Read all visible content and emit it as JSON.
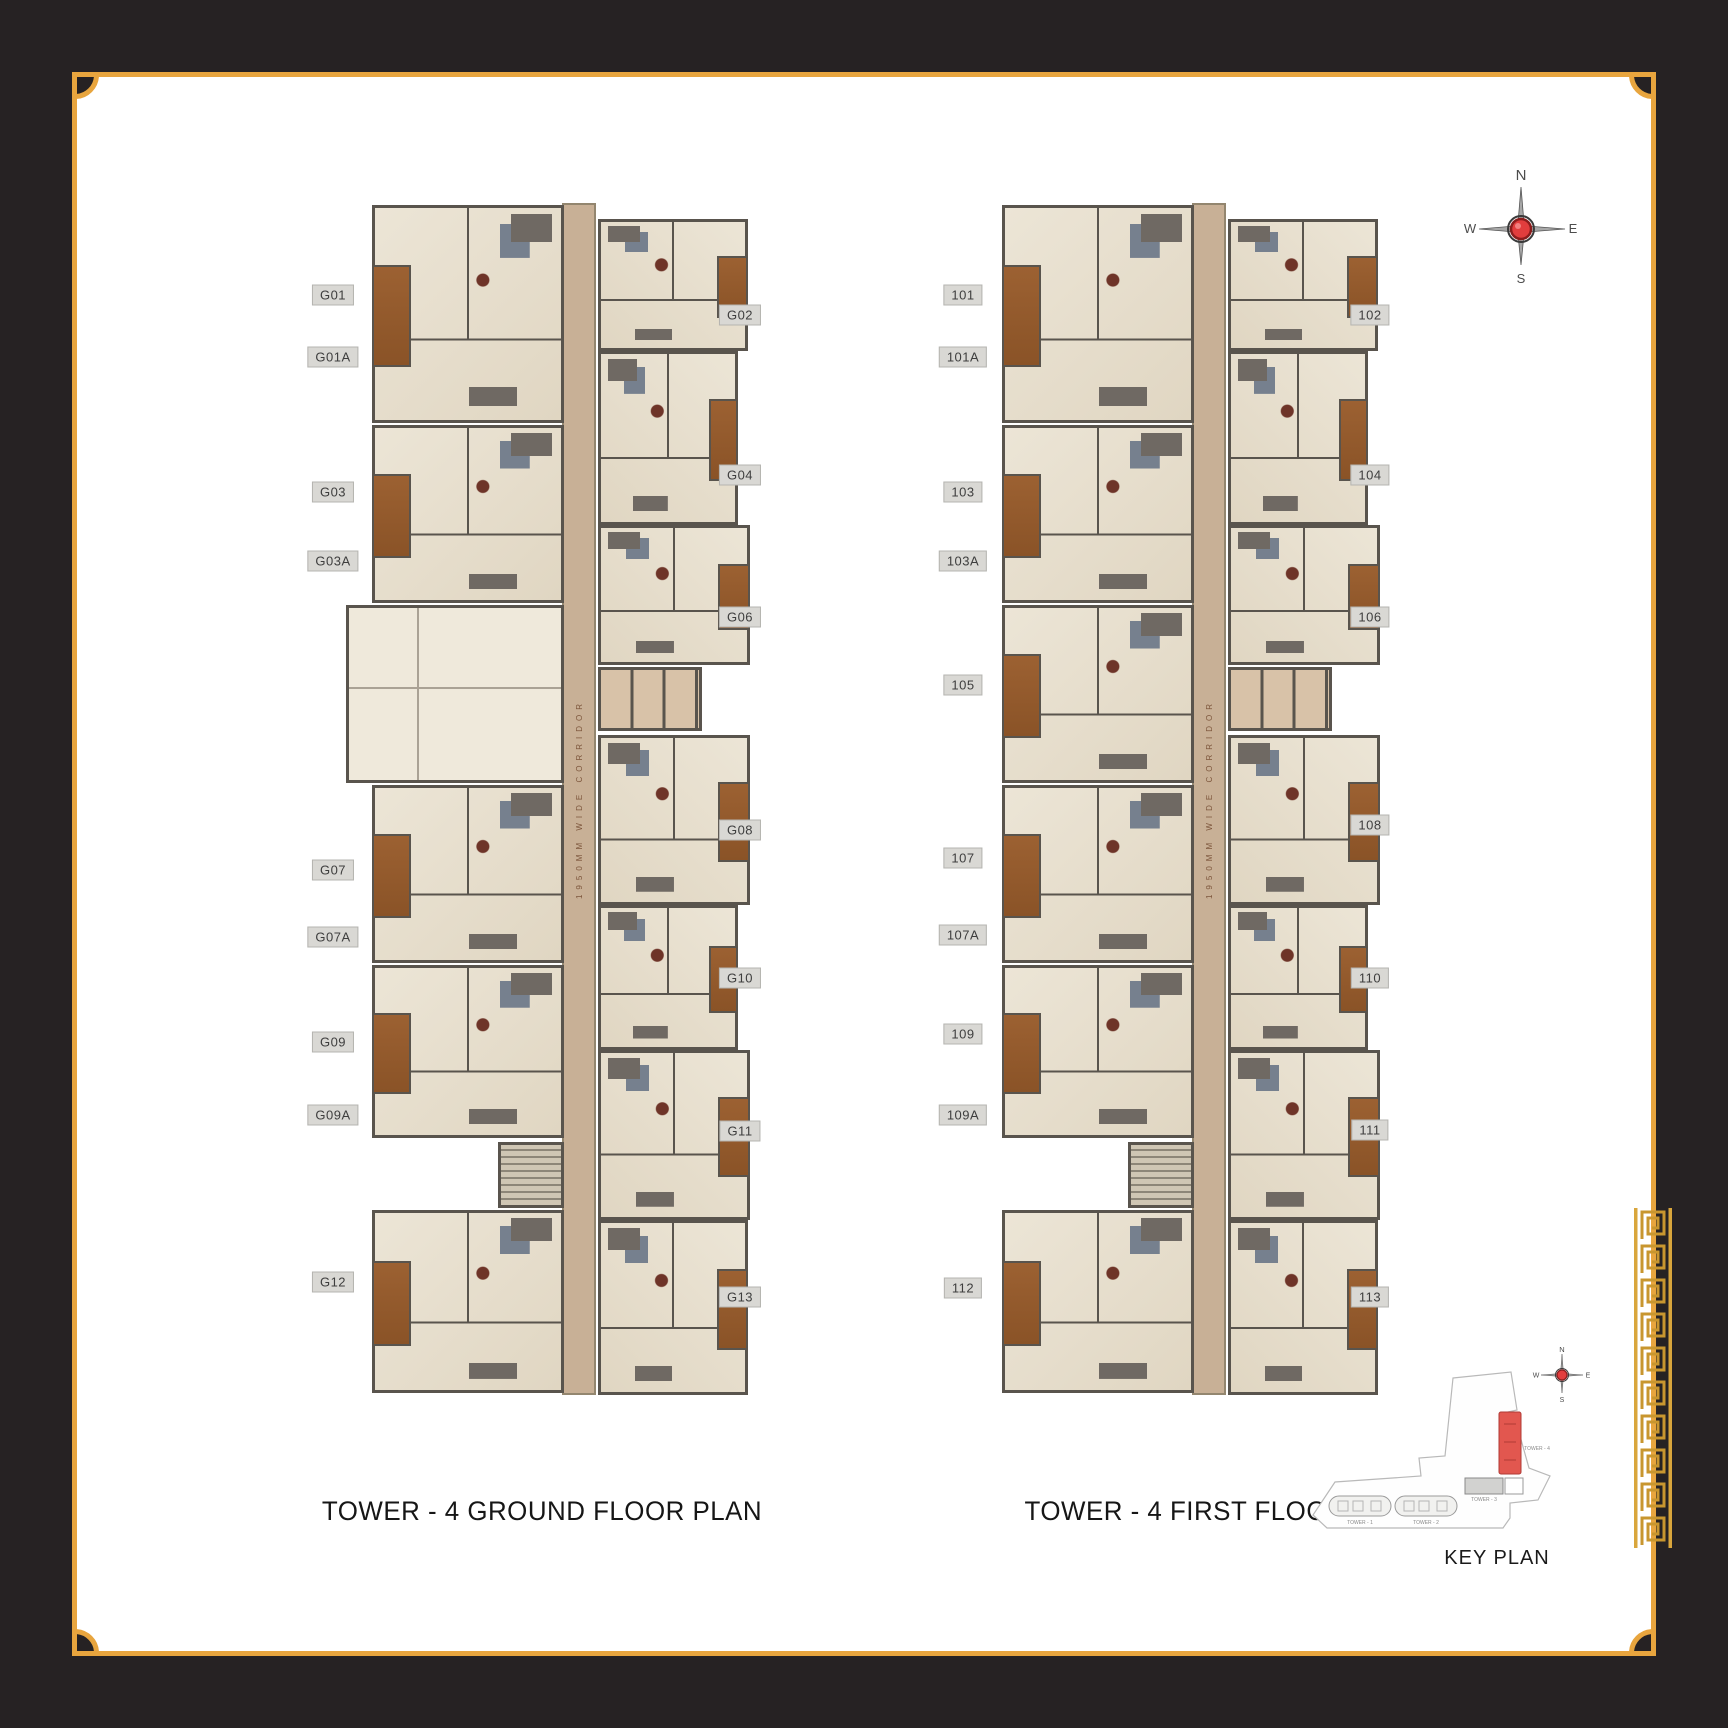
{
  "page": {
    "frame_color": "#262223",
    "gold": "#e8a53e",
    "highlight_red": "#e2574f",
    "plans": [
      {
        "title": "TOWER - 4 GROUND FLOOR PLAN",
        "corridor_label": "1950MM WIDE CORRIDOR",
        "left_units": [
          {
            "label": "G01",
            "top": 98
          },
          {
            "label": "G01A",
            "top": 160
          },
          {
            "label": "G03",
            "top": 295
          },
          {
            "label": "G03A",
            "top": 364
          },
          {
            "label": "G07",
            "top": 673
          },
          {
            "label": "G07A",
            "top": 740
          },
          {
            "label": "G09",
            "top": 845
          },
          {
            "label": "G09A",
            "top": 918
          },
          {
            "label": "G12",
            "top": 1085
          }
        ],
        "right_units": [
          {
            "label": "G02",
            "top": 118
          },
          {
            "label": "G04",
            "top": 278
          },
          {
            "label": "G06",
            "top": 420
          },
          {
            "label": "G08",
            "top": 633
          },
          {
            "label": "G10",
            "top": 781
          },
          {
            "label": "G11",
            "top": 934
          },
          {
            "label": "G13",
            "top": 1100
          }
        ]
      },
      {
        "title": "TOWER - 4 FIRST FLOOR PLAN",
        "corridor_label": "1950MM WIDE CORRIDOR",
        "left_units": [
          {
            "label": "101",
            "top": 98
          },
          {
            "label": "101A",
            "top": 160
          },
          {
            "label": "103",
            "top": 295
          },
          {
            "label": "103A",
            "top": 364
          },
          {
            "label": "105",
            "top": 488
          },
          {
            "label": "107",
            "top": 661
          },
          {
            "label": "107A",
            "top": 738
          },
          {
            "label": "109",
            "top": 837
          },
          {
            "label": "109A",
            "top": 918
          },
          {
            "label": "112",
            "top": 1091
          }
        ],
        "right_units": [
          {
            "label": "102",
            "top": 118
          },
          {
            "label": "104",
            "top": 278
          },
          {
            "label": "106",
            "top": 420
          },
          {
            "label": "108",
            "top": 628
          },
          {
            "label": "110",
            "top": 781
          },
          {
            "label": "111",
            "top": 933
          },
          {
            "label": "113",
            "top": 1100
          }
        ]
      }
    ],
    "compass": {
      "north": "N",
      "east": "E",
      "south": "S",
      "west": "W"
    },
    "key_plan": {
      "title": "KEY PLAN",
      "towers": [
        "TOWER - 1",
        "TOWER - 2",
        "TOWER - 3",
        "TOWER - 4"
      ]
    }
  }
}
